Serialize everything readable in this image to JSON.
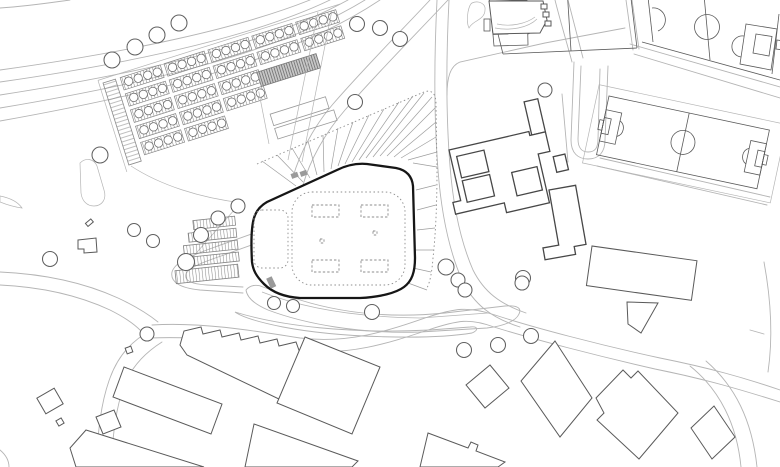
{
  "meta": {
    "title": "Architectural site plan",
    "description": "Black-and-white architectural site plan: a central arena with a radiating forecourt plaza, allotment gardens to the north-west, three football pitches to the north-east, a school courtyard complex, hatched parking rows, tree circles, wedge-shaped drop-off strips and surrounding industrial buildings linked by curving roads.",
    "canvas": {
      "width": 780,
      "height": 467
    }
  },
  "colors": {
    "background": "#ffffff",
    "road": "#b5b5b5",
    "building_outline": "#5a5a5a",
    "heavy_outline": "#474747",
    "arena_outline": "#161616",
    "dotted_line": "#8d8d8d",
    "hatch_line": "#8a8a8a",
    "tree_outline": "#606060",
    "gray_fill": "#9a9a9a"
  },
  "features": {
    "arena": {
      "kind": "building",
      "style": "thick black organic outline, dotted halls, 4 dashed courts"
    },
    "forecourt_plaza": {
      "kind": "open space",
      "style": "fan of radiating lines with dotted boundary"
    },
    "allotment_gardens": {
      "kind": "garden plots",
      "plot_clusters": 19,
      "style": "hatched plots with tree circles"
    },
    "football_pitches": {
      "kind": "sports field",
      "count": 3
    },
    "school_complex": {
      "kind": "building",
      "courtyards": 3
    },
    "parking_rows": {
      "kind": "parking",
      "count": 5,
      "style": "hatched strips"
    },
    "trees": {
      "kind": "vegetation",
      "count": 29,
      "style": "outlined circles"
    },
    "industrial_buildings": {
      "kind": "building",
      "style": "rotated rectangles and sawtooth block"
    }
  }
}
